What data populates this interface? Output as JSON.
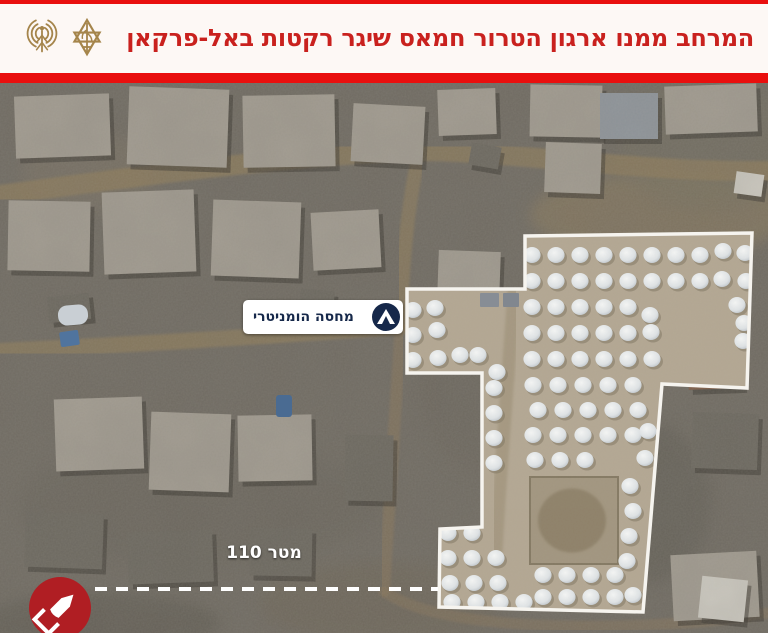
{
  "header": {
    "title": "המרחב ממנו ארגון הטרור חמאס שיגר רקטות באל-פרקאן",
    "logos": [
      "idf-spokesperson-radio-logo",
      "idf-emblem-logo"
    ]
  },
  "theme": {
    "accent_red": "#e90f0e",
    "title_red": "#c9211e",
    "logo_gold": "#a5854b",
    "navy": "#16284a",
    "header_bg": "#fdf8f5"
  },
  "map": {
    "base_color": "#6f6a61",
    "building_tones": {
      "a": "#a09a8f",
      "b": "#8e949a",
      "c": "#7d5b45",
      "d": "#6b675e",
      "e": "#ccc9c0"
    },
    "patches": [
      [
        660,
        132,
        130,
        42,
        "#8b7a5c",
        0.55
      ],
      [
        705,
        62,
        85,
        68,
        "#75705e",
        0.45
      ],
      [
        90,
        90,
        70,
        40,
        "#7e7465",
        0.4
      ],
      [
        480,
        300,
        60,
        90,
        "#6a655c",
        0.5
      ],
      [
        200,
        420,
        180,
        60,
        "#67635a",
        0.45
      ],
      [
        650,
        420,
        60,
        80,
        "#5f5b52",
        0.5
      ],
      [
        380,
        520,
        120,
        40,
        "#6e6555",
        0.45
      ],
      [
        100,
        540,
        120,
        30,
        "#5a564d",
        0.5
      ]
    ],
    "roads": [
      {
        "d": "M0,112 C120,96 300,70 430,68 C520,70 650,90 768,88",
        "w": 20,
        "color": "#8c7a5a",
        "op": 0.75
      },
      {
        "d": "M420,66 C408,120 402,180 401,240",
        "w": 14,
        "color": "#8c7a5a",
        "op": 0.7
      },
      {
        "d": "M0,268 C130,262 280,252 401,244",
        "w": 16,
        "color": "#8c7a5a",
        "op": 0.75
      },
      {
        "d": "M401,240 C395,330 389,430 384,508",
        "w": 12,
        "color": "#87755a",
        "op": 0.6
      },
      {
        "d": "M384,508 C430,542 560,549 700,539 C730,536 768,530 768,530",
        "w": 11,
        "color": "#87755a",
        "op": 0.5
      }
    ],
    "buildings": [
      [
        15,
        12,
        95,
        62,
        -2,
        "a"
      ],
      [
        128,
        5,
        100,
        78,
        2,
        "a"
      ],
      [
        243,
        12,
        92,
        72,
        -1,
        "a"
      ],
      [
        352,
        22,
        72,
        58,
        3,
        "a"
      ],
      [
        438,
        6,
        58,
        46,
        -2,
        "a"
      ],
      [
        530,
        2,
        72,
        52,
        1,
        "a"
      ],
      [
        600,
        10,
        58,
        46,
        0,
        "b"
      ],
      [
        665,
        2,
        92,
        48,
        -2,
        "a"
      ],
      [
        545,
        60,
        56,
        50,
        2,
        "a"
      ],
      [
        735,
        90,
        28,
        22,
        8,
        "e"
      ],
      [
        8,
        118,
        82,
        70,
        1,
        "a"
      ],
      [
        103,
        108,
        92,
        82,
        -2,
        "a"
      ],
      [
        212,
        118,
        88,
        76,
        2,
        "a"
      ],
      [
        312,
        128,
        68,
        58,
        -3,
        "a"
      ],
      [
        438,
        168,
        62,
        48,
        2,
        "a"
      ],
      [
        55,
        315,
        88,
        72,
        -2,
        "a"
      ],
      [
        150,
        330,
        80,
        78,
        2,
        "a"
      ],
      [
        238,
        332,
        74,
        66,
        -1,
        "a"
      ],
      [
        345,
        352,
        48,
        66,
        1,
        "d"
      ],
      [
        25,
        430,
        78,
        55,
        2,
        "d"
      ],
      [
        128,
        448,
        85,
        52,
        -2,
        "d"
      ],
      [
        250,
        445,
        62,
        48,
        1,
        "d"
      ],
      [
        688,
        262,
        54,
        44,
        -2,
        "c"
      ],
      [
        692,
        330,
        66,
        56,
        2,
        "d"
      ],
      [
        672,
        470,
        86,
        66,
        -3,
        "a"
      ],
      [
        700,
        495,
        46,
        42,
        6,
        "e"
      ],
      [
        470,
        62,
        30,
        22,
        10,
        "d"
      ],
      [
        48,
        212,
        42,
        26,
        -6,
        "d"
      ],
      [
        300,
        207,
        34,
        22,
        5,
        "d"
      ],
      [
        620,
        242,
        28,
        18,
        -8,
        "d"
      ]
    ],
    "camp": {
      "outline_points": "525,153 752,150 747,305 662,301 643,529 439,524 440,446 482,444 482,290 407,290 407,206 525,206",
      "ground_color": "#b3a793",
      "outline_color": "#f6f4ef",
      "road": {
        "d": "M514,206 C508,300 500,390 496,470",
        "w": 13,
        "color": "#a3967f",
        "op": 0.85
      },
      "pit": {
        "x": 530,
        "y": 394,
        "w": 88,
        "h": 87,
        "fill": "#a29680",
        "stroke": "#857a64",
        "mound": "#8f826a"
      },
      "tents": [
        [
          532,
          172
        ],
        [
          556,
          172
        ],
        [
          580,
          172
        ],
        [
          604,
          172
        ],
        [
          628,
          172
        ],
        [
          652,
          172
        ],
        [
          676,
          172
        ],
        [
          700,
          172
        ],
        [
          723,
          168
        ],
        [
          745,
          170
        ],
        [
          532,
          198
        ],
        [
          556,
          198
        ],
        [
          580,
          198
        ],
        [
          604,
          198
        ],
        [
          628,
          198
        ],
        [
          652,
          198
        ],
        [
          676,
          198
        ],
        [
          700,
          198
        ],
        [
          722,
          196
        ],
        [
          746,
          198
        ],
        [
          532,
          224
        ],
        [
          556,
          224
        ],
        [
          580,
          224
        ],
        [
          604,
          224
        ],
        [
          628,
          224
        ],
        [
          650,
          232
        ],
        [
          737,
          222
        ],
        [
          744,
          240
        ],
        [
          532,
          250
        ],
        [
          556,
          250
        ],
        [
          580,
          250
        ],
        [
          604,
          250
        ],
        [
          628,
          250
        ],
        [
          651,
          249
        ],
        [
          743,
          258
        ],
        [
          532,
          276
        ],
        [
          556,
          276
        ],
        [
          580,
          276
        ],
        [
          604,
          276
        ],
        [
          628,
          276
        ],
        [
          652,
          276
        ],
        [
          413,
          227
        ],
        [
          435,
          225
        ],
        [
          413,
          252
        ],
        [
          437,
          247
        ],
        [
          413,
          277
        ],
        [
          438,
          275
        ],
        [
          460,
          272
        ],
        [
          478,
          272
        ],
        [
          497,
          289
        ],
        [
          494,
          305
        ],
        [
          494,
          330
        ],
        [
          494,
          355
        ],
        [
          494,
          380
        ],
        [
          533,
          302
        ],
        [
          558,
          302
        ],
        [
          583,
          302
        ],
        [
          608,
          302
        ],
        [
          633,
          302
        ],
        [
          538,
          327
        ],
        [
          563,
          327
        ],
        [
          588,
          327
        ],
        [
          613,
          327
        ],
        [
          638,
          327
        ],
        [
          533,
          352
        ],
        [
          558,
          352
        ],
        [
          583,
          352
        ],
        [
          608,
          352
        ],
        [
          633,
          352
        ],
        [
          648,
          348
        ],
        [
          535,
          377
        ],
        [
          560,
          377
        ],
        [
          585,
          377
        ],
        [
          645,
          375
        ],
        [
          630,
          403
        ],
        [
          633,
          428
        ],
        [
          629,
          453
        ],
        [
          627,
          478
        ],
        [
          448,
          450
        ],
        [
          472,
          450
        ],
        [
          448,
          475
        ],
        [
          472,
          475
        ],
        [
          496,
          475
        ],
        [
          450,
          500
        ],
        [
          474,
          500
        ],
        [
          498,
          500
        ],
        [
          452,
          519
        ],
        [
          476,
          519
        ],
        [
          500,
          519
        ],
        [
          524,
          519
        ],
        [
          543,
          492
        ],
        [
          567,
          492
        ],
        [
          591,
          492
        ],
        [
          615,
          492
        ],
        [
          543,
          514
        ],
        [
          567,
          514
        ],
        [
          591,
          514
        ],
        [
          615,
          514
        ],
        [
          633,
          512
        ]
      ]
    },
    "blue_items": [
      {
        "x": 58,
        "y": 222,
        "w": 30,
        "h": 20,
        "color": "#c9cfd4",
        "rot": -5,
        "rx": 9
      },
      {
        "x": 60,
        "y": 248,
        "w": 19,
        "h": 15,
        "color": "#50749e",
        "rot": -8,
        "rx": 2
      },
      {
        "x": 276,
        "y": 312,
        "w": 16,
        "h": 22,
        "color": "#4a6b92",
        "rot": 0,
        "rx": 3
      },
      {
        "x": 480,
        "y": 210,
        "w": 19,
        "h": 14,
        "color": "#878d95",
        "rot": 0,
        "rx": 1
      },
      {
        "x": 503,
        "y": 210,
        "w": 16,
        "h": 14,
        "color": "#81878f",
        "rot": 0,
        "rx": 1
      }
    ],
    "shelter_label": {
      "text": "מחסה הומניטרי",
      "text_color": "#16284a",
      "bg_color": "#ffffff",
      "icon": "tent-icon",
      "icon_bg": "#16284a"
    },
    "distance_label": {
      "text": "110 מטר",
      "color": "#ffffff"
    },
    "distance_line": {
      "x1": 95,
      "y1": 506,
      "x2": 438,
      "y2": 506,
      "color": "#ffffff"
    },
    "launch_badge": {
      "icon": "rocket-icon",
      "bg_color": "#b01e23",
      "cx": 60,
      "cy": 525,
      "r": 31
    }
  }
}
